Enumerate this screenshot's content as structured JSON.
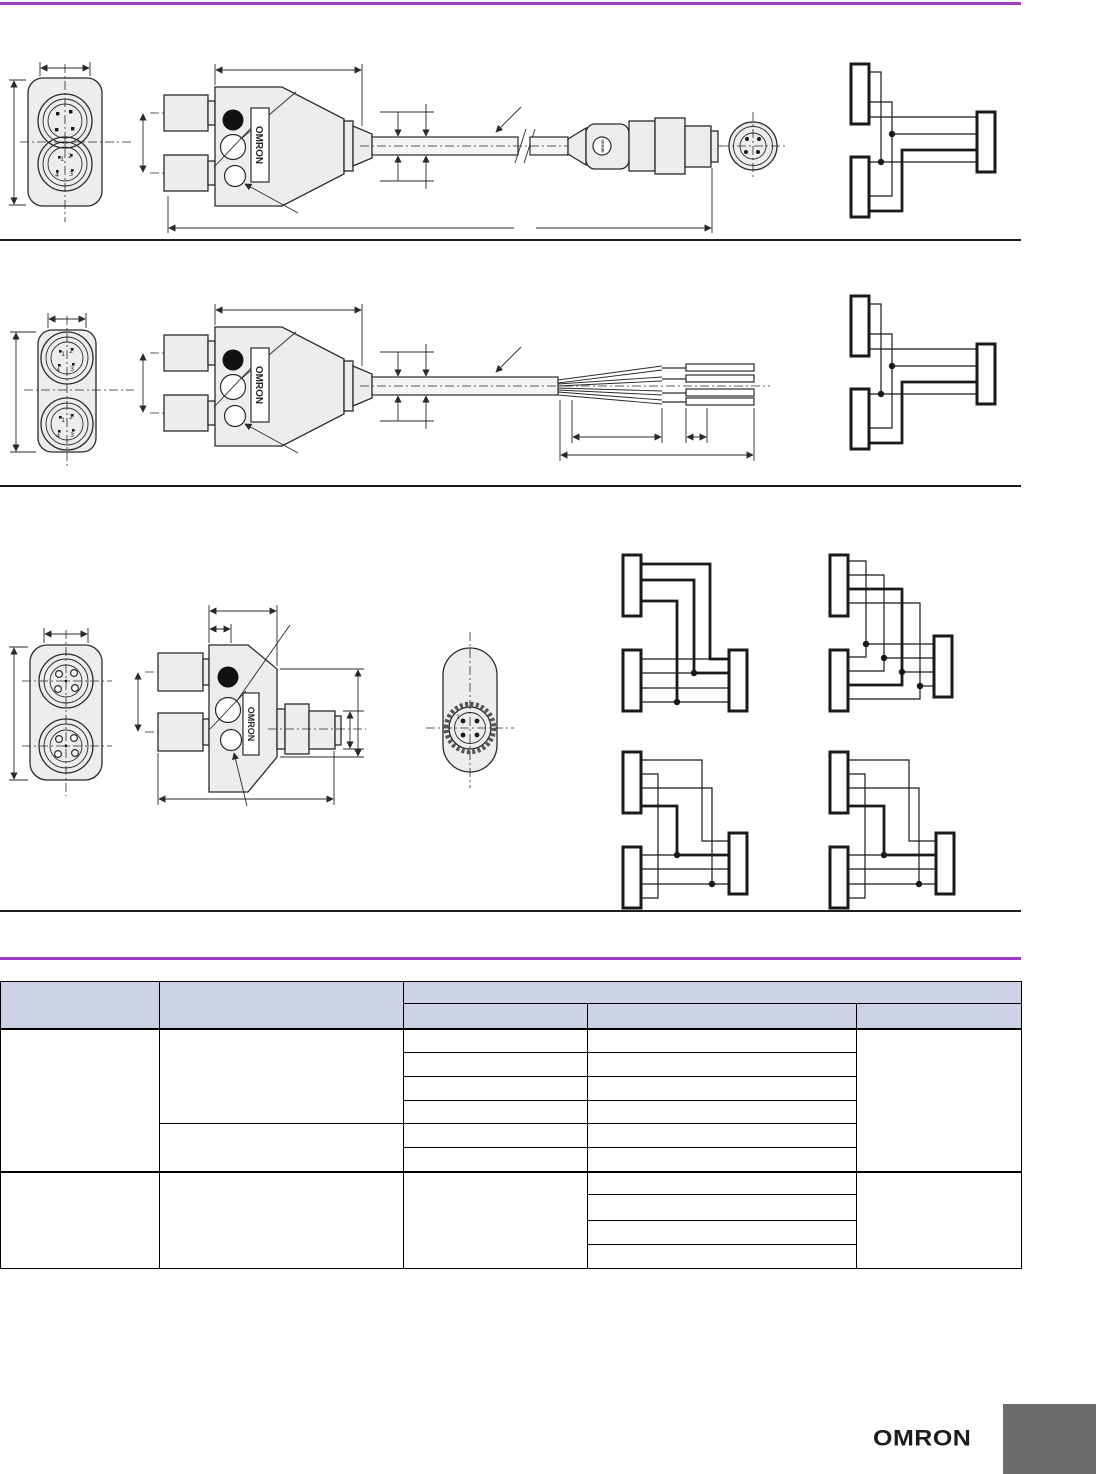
{
  "page": {
    "background": "#ffffff",
    "accent_color": "#9d3cc0",
    "rule_color": "#1d1d1d",
    "content_width_px": 1021
  },
  "brand": {
    "device_label": "OMRON",
    "connector_emblem_label": "omron",
    "footer_logo": "OMRON"
  },
  "figures": {
    "fig1": {
      "description": "Y-joint splitter with cable and M12 male connector",
      "pins_lower_connector": [
        "1",
        "2",
        "3",
        "4"
      ]
    },
    "fig2": {
      "description": "Y-joint splitter with cable and discrete wire ends",
      "pins_upper_connector": [
        "1",
        "2",
        "3",
        "4"
      ],
      "pins_lower_connector": [
        "1",
        "2",
        "3",
        "4"
      ]
    },
    "fig3": {
      "description": "Y-joint plug without cable",
      "face_pin_label": "1"
    }
  },
  "table": {
    "header_fill": "#cdd3e4",
    "border_color": "#000000",
    "column_widths_px": [
      159,
      244,
      184,
      269,
      165
    ],
    "header": {
      "col1": "",
      "col2": "",
      "group": "",
      "sub1": "",
      "sub2": "",
      "sub3": ""
    },
    "body": {
      "g1_col1": "",
      "g1_col2a": "",
      "g1_col2b": "",
      "g1_c3": [
        "",
        "",
        "",
        "",
        "",
        ""
      ],
      "g1_c4": [
        "",
        "",
        "",
        "",
        "",
        ""
      ],
      "g1_col5": "",
      "g2_col1": "",
      "g2_col2": "",
      "g2_col3": "",
      "g2_c4": [
        "",
        "",
        "",
        ""
      ],
      "g2_col5": ""
    }
  },
  "footer": {
    "tab_color": "#6b6b6b"
  }
}
